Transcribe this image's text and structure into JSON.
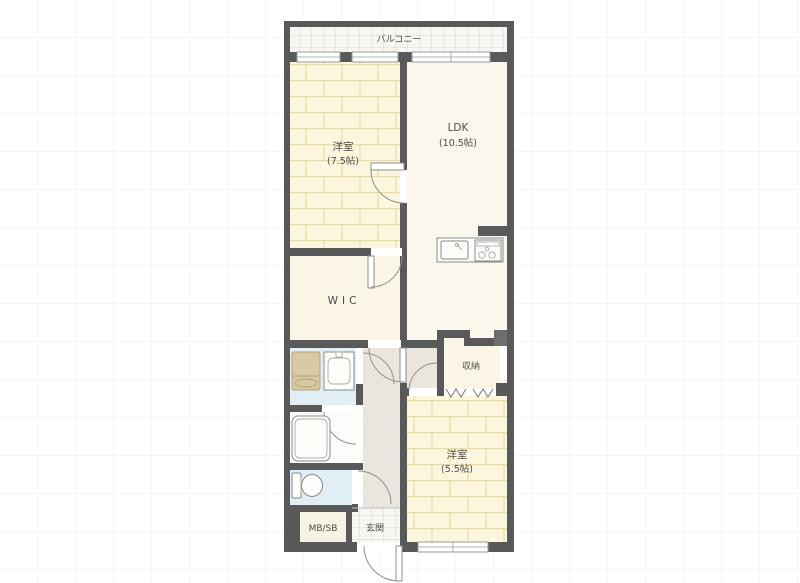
{
  "plan": {
    "type": "apartment-floorplan",
    "rooms": {
      "balcony": {
        "label": "バルコニー"
      },
      "bedroom_main": {
        "label": "洋室",
        "size": "(7.5帖)"
      },
      "ldk": {
        "label": "LDK",
        "size": "(10.5帖)"
      },
      "wic": {
        "label": "WIC"
      },
      "storage": {
        "label": "収納"
      },
      "bedroom_second": {
        "label": "洋室",
        "size": "(5.5帖)"
      },
      "meter_box": {
        "label": "MB/SB"
      },
      "entrance": {
        "label": "玄関"
      }
    },
    "fixtures": [
      "kitchen-sink",
      "gas-stove",
      "washing-machine",
      "washbasin",
      "bathtub",
      "toilet"
    ],
    "colors": {
      "wall": "#595959",
      "brick_room_floor": "#fcf6de",
      "brick_line": "#e9dc9e",
      "ldk_floor": "#fbf7ec",
      "plain_room_floor": "#faf5e4",
      "hallway_floor": "#ebe6dd",
      "wet_area_floor": "#e1eef6",
      "tile_floor": "#f7f6f2",
      "washer_fill": "#d9c9a2",
      "pillar": "#6e6e6e",
      "background_grid": "#ededed"
    }
  }
}
